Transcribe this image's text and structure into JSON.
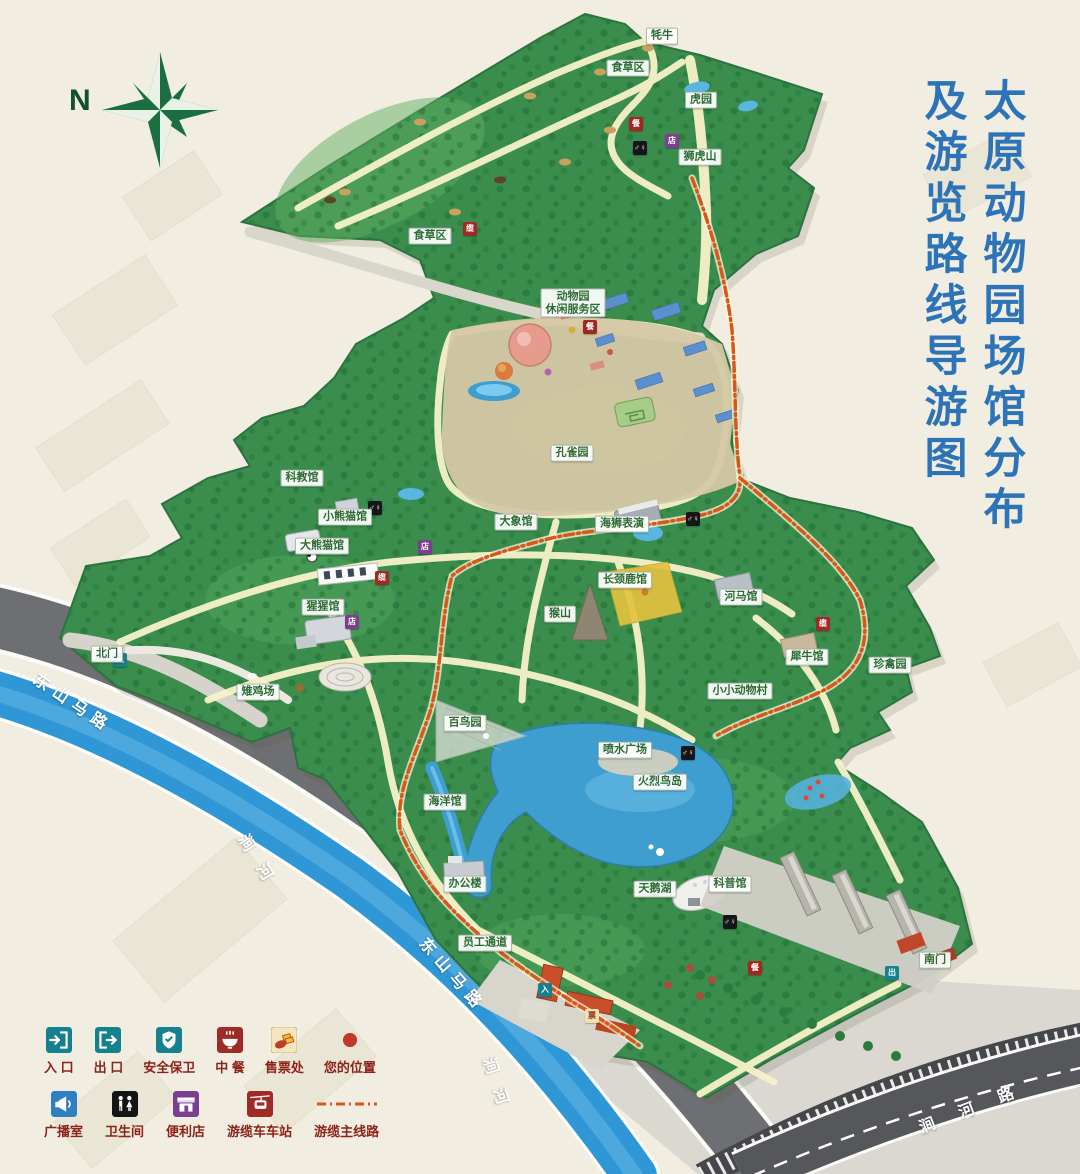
{
  "page": {
    "width": 1080,
    "height": 1174
  },
  "title": {
    "line1": "太原动物园场馆分布",
    "line2": "及游览路线导游图"
  },
  "compass": {
    "label": "N"
  },
  "roads": {
    "dongshan": "东山马路",
    "jianhe_river": "涧河",
    "jianhe_road": "涧河路"
  },
  "colors": {
    "title_blue": "#2c73b8",
    "legend_text": "#8d2318",
    "park_green": "#3a8d4d",
    "tree_green": "#1e6b33",
    "water_blue": "#2f97d5",
    "road_grey": "#6e6f72",
    "path_cream": "#f7f2c9",
    "cable_orange": "#d8571a",
    "compass_green": "#1b6e3f",
    "label_text": "#2c6b33",
    "gate_red": "#c84f2a"
  },
  "map_labels": [
    {
      "id": "yak",
      "text": "牦牛",
      "x": 662,
      "y": 36
    },
    {
      "id": "herbivore-area-1",
      "text": "食草区",
      "x": 628,
      "y": 68
    },
    {
      "id": "tiger-garden",
      "text": "虎园",
      "x": 701,
      "y": 100
    },
    {
      "id": "lion-tiger-hill",
      "text": "狮虎山",
      "x": 700,
      "y": 157
    },
    {
      "id": "herbivore-area-2",
      "text": "食草区",
      "x": 430,
      "y": 236
    },
    {
      "id": "leisure-zone",
      "text": "动物园\n休闲服务区",
      "x": 573,
      "y": 303
    },
    {
      "id": "peacock-garden",
      "text": "孔雀园",
      "x": 572,
      "y": 453
    },
    {
      "id": "science-hall",
      "text": "科教馆",
      "x": 302,
      "y": 478
    },
    {
      "id": "red-panda-house",
      "text": "小熊猫馆",
      "x": 345,
      "y": 517
    },
    {
      "id": "giant-panda-house",
      "text": "大熊猫馆",
      "x": 322,
      "y": 546
    },
    {
      "id": "elephant-house",
      "text": "大象馆",
      "x": 516,
      "y": 522
    },
    {
      "id": "sea-lion-show",
      "text": "海狮表演",
      "x": 622,
      "y": 524
    },
    {
      "id": "giraffe-house",
      "text": "长颈鹿馆",
      "x": 625,
      "y": 580
    },
    {
      "id": "hippo-house",
      "text": "河马馆",
      "x": 741,
      "y": 597
    },
    {
      "id": "monkey-hill",
      "text": "猴山",
      "x": 560,
      "y": 614
    },
    {
      "id": "orangutan-house",
      "text": "猩猩馆",
      "x": 323,
      "y": 607
    },
    {
      "id": "rhino-house",
      "text": "犀牛馆",
      "x": 807,
      "y": 657
    },
    {
      "id": "rare-birds-garden",
      "text": "珍禽园",
      "x": 890,
      "y": 665
    },
    {
      "id": "pheasant-yard",
      "text": "雉鸡场",
      "x": 258,
      "y": 692
    },
    {
      "id": "mini-zoo-village",
      "text": "小小动物村",
      "x": 740,
      "y": 691
    },
    {
      "id": "bird-garden",
      "text": "百鸟园",
      "x": 465,
      "y": 723
    },
    {
      "id": "fountain-square",
      "text": "喷水广场",
      "x": 625,
      "y": 750
    },
    {
      "id": "flamingo-island",
      "text": "火烈鸟岛",
      "x": 660,
      "y": 782
    },
    {
      "id": "ocean-hall",
      "text": "海洋馆",
      "x": 445,
      "y": 802
    },
    {
      "id": "office-building",
      "text": "办公楼",
      "x": 465,
      "y": 884
    },
    {
      "id": "swan-lake",
      "text": "天鹅湖",
      "x": 655,
      "y": 889
    },
    {
      "id": "science-museum",
      "text": "科普馆",
      "x": 730,
      "y": 884
    },
    {
      "id": "south-gate",
      "text": "南门",
      "x": 935,
      "y": 960
    },
    {
      "id": "north-gate",
      "text": "北门",
      "x": 107,
      "y": 654
    },
    {
      "id": "staff-passage",
      "text": "员工通道",
      "x": 485,
      "y": 943
    }
  ],
  "marker_types": {
    "toilet": {
      "glyph": "♂♀",
      "bg": "#16161a",
      "fg": "#ffffff"
    },
    "food": {
      "glyph": "餐",
      "bg": "#a3271f",
      "fg": "#ffffff"
    },
    "store": {
      "glyph": "店",
      "bg": "#7b3f8f",
      "fg": "#ffffff"
    },
    "cable-station": {
      "glyph": "缆",
      "bg": "#9e2b25",
      "fg": "#ffffff"
    },
    "entrance": {
      "glyph": "入",
      "bg": "#15808e",
      "fg": "#ffffff"
    },
    "exit": {
      "glyph": "出",
      "bg": "#15808e",
      "fg": "#ffffff"
    },
    "ticket": {
      "glyph": "票",
      "bg": "#f2e2b0",
      "fg": "#8d2318"
    }
  },
  "markers": [
    {
      "type": "toilet",
      "x": 640,
      "y": 148
    },
    {
      "type": "toilet",
      "x": 375,
      "y": 508
    },
    {
      "type": "toilet",
      "x": 693,
      "y": 519
    },
    {
      "type": "toilet",
      "x": 688,
      "y": 753
    },
    {
      "type": "toilet",
      "x": 730,
      "y": 922
    },
    {
      "type": "food",
      "x": 636,
      "y": 124
    },
    {
      "type": "food",
      "x": 590,
      "y": 327
    },
    {
      "type": "food",
      "x": 755,
      "y": 968
    },
    {
      "type": "store",
      "x": 672,
      "y": 141
    },
    {
      "type": "store",
      "x": 425,
      "y": 547
    },
    {
      "type": "store",
      "x": 352,
      "y": 622
    },
    {
      "type": "cable-station",
      "x": 470,
      "y": 229
    },
    {
      "type": "cable-station",
      "x": 382,
      "y": 578
    },
    {
      "type": "cable-station",
      "x": 823,
      "y": 624
    },
    {
      "type": "entrance",
      "x": 120,
      "y": 660
    },
    {
      "type": "entrance",
      "x": 545,
      "y": 990
    },
    {
      "type": "exit",
      "x": 892,
      "y": 973
    },
    {
      "type": "ticket",
      "x": 592,
      "y": 1016
    }
  ],
  "legend": {
    "rows": [
      [
        {
          "id": "entrance",
          "label": "入 口"
        },
        {
          "id": "exit",
          "label": "出 口"
        },
        {
          "id": "security",
          "label": "安全保卫"
        },
        {
          "id": "chinese-food",
          "label": "中 餐"
        },
        {
          "id": "ticket-office",
          "label": "售票处"
        },
        {
          "id": "your-location",
          "label": "您的位置"
        }
      ],
      [
        {
          "id": "broadcast-room",
          "label": "广播室"
        },
        {
          "id": "restroom",
          "label": "卫生间"
        },
        {
          "id": "convenience-store",
          "label": "便利店"
        },
        {
          "id": "cable-car-station",
          "label": "游缆车车站"
        },
        {
          "id": "cable-main-line",
          "label": "游缆主线路"
        }
      ]
    ]
  }
}
